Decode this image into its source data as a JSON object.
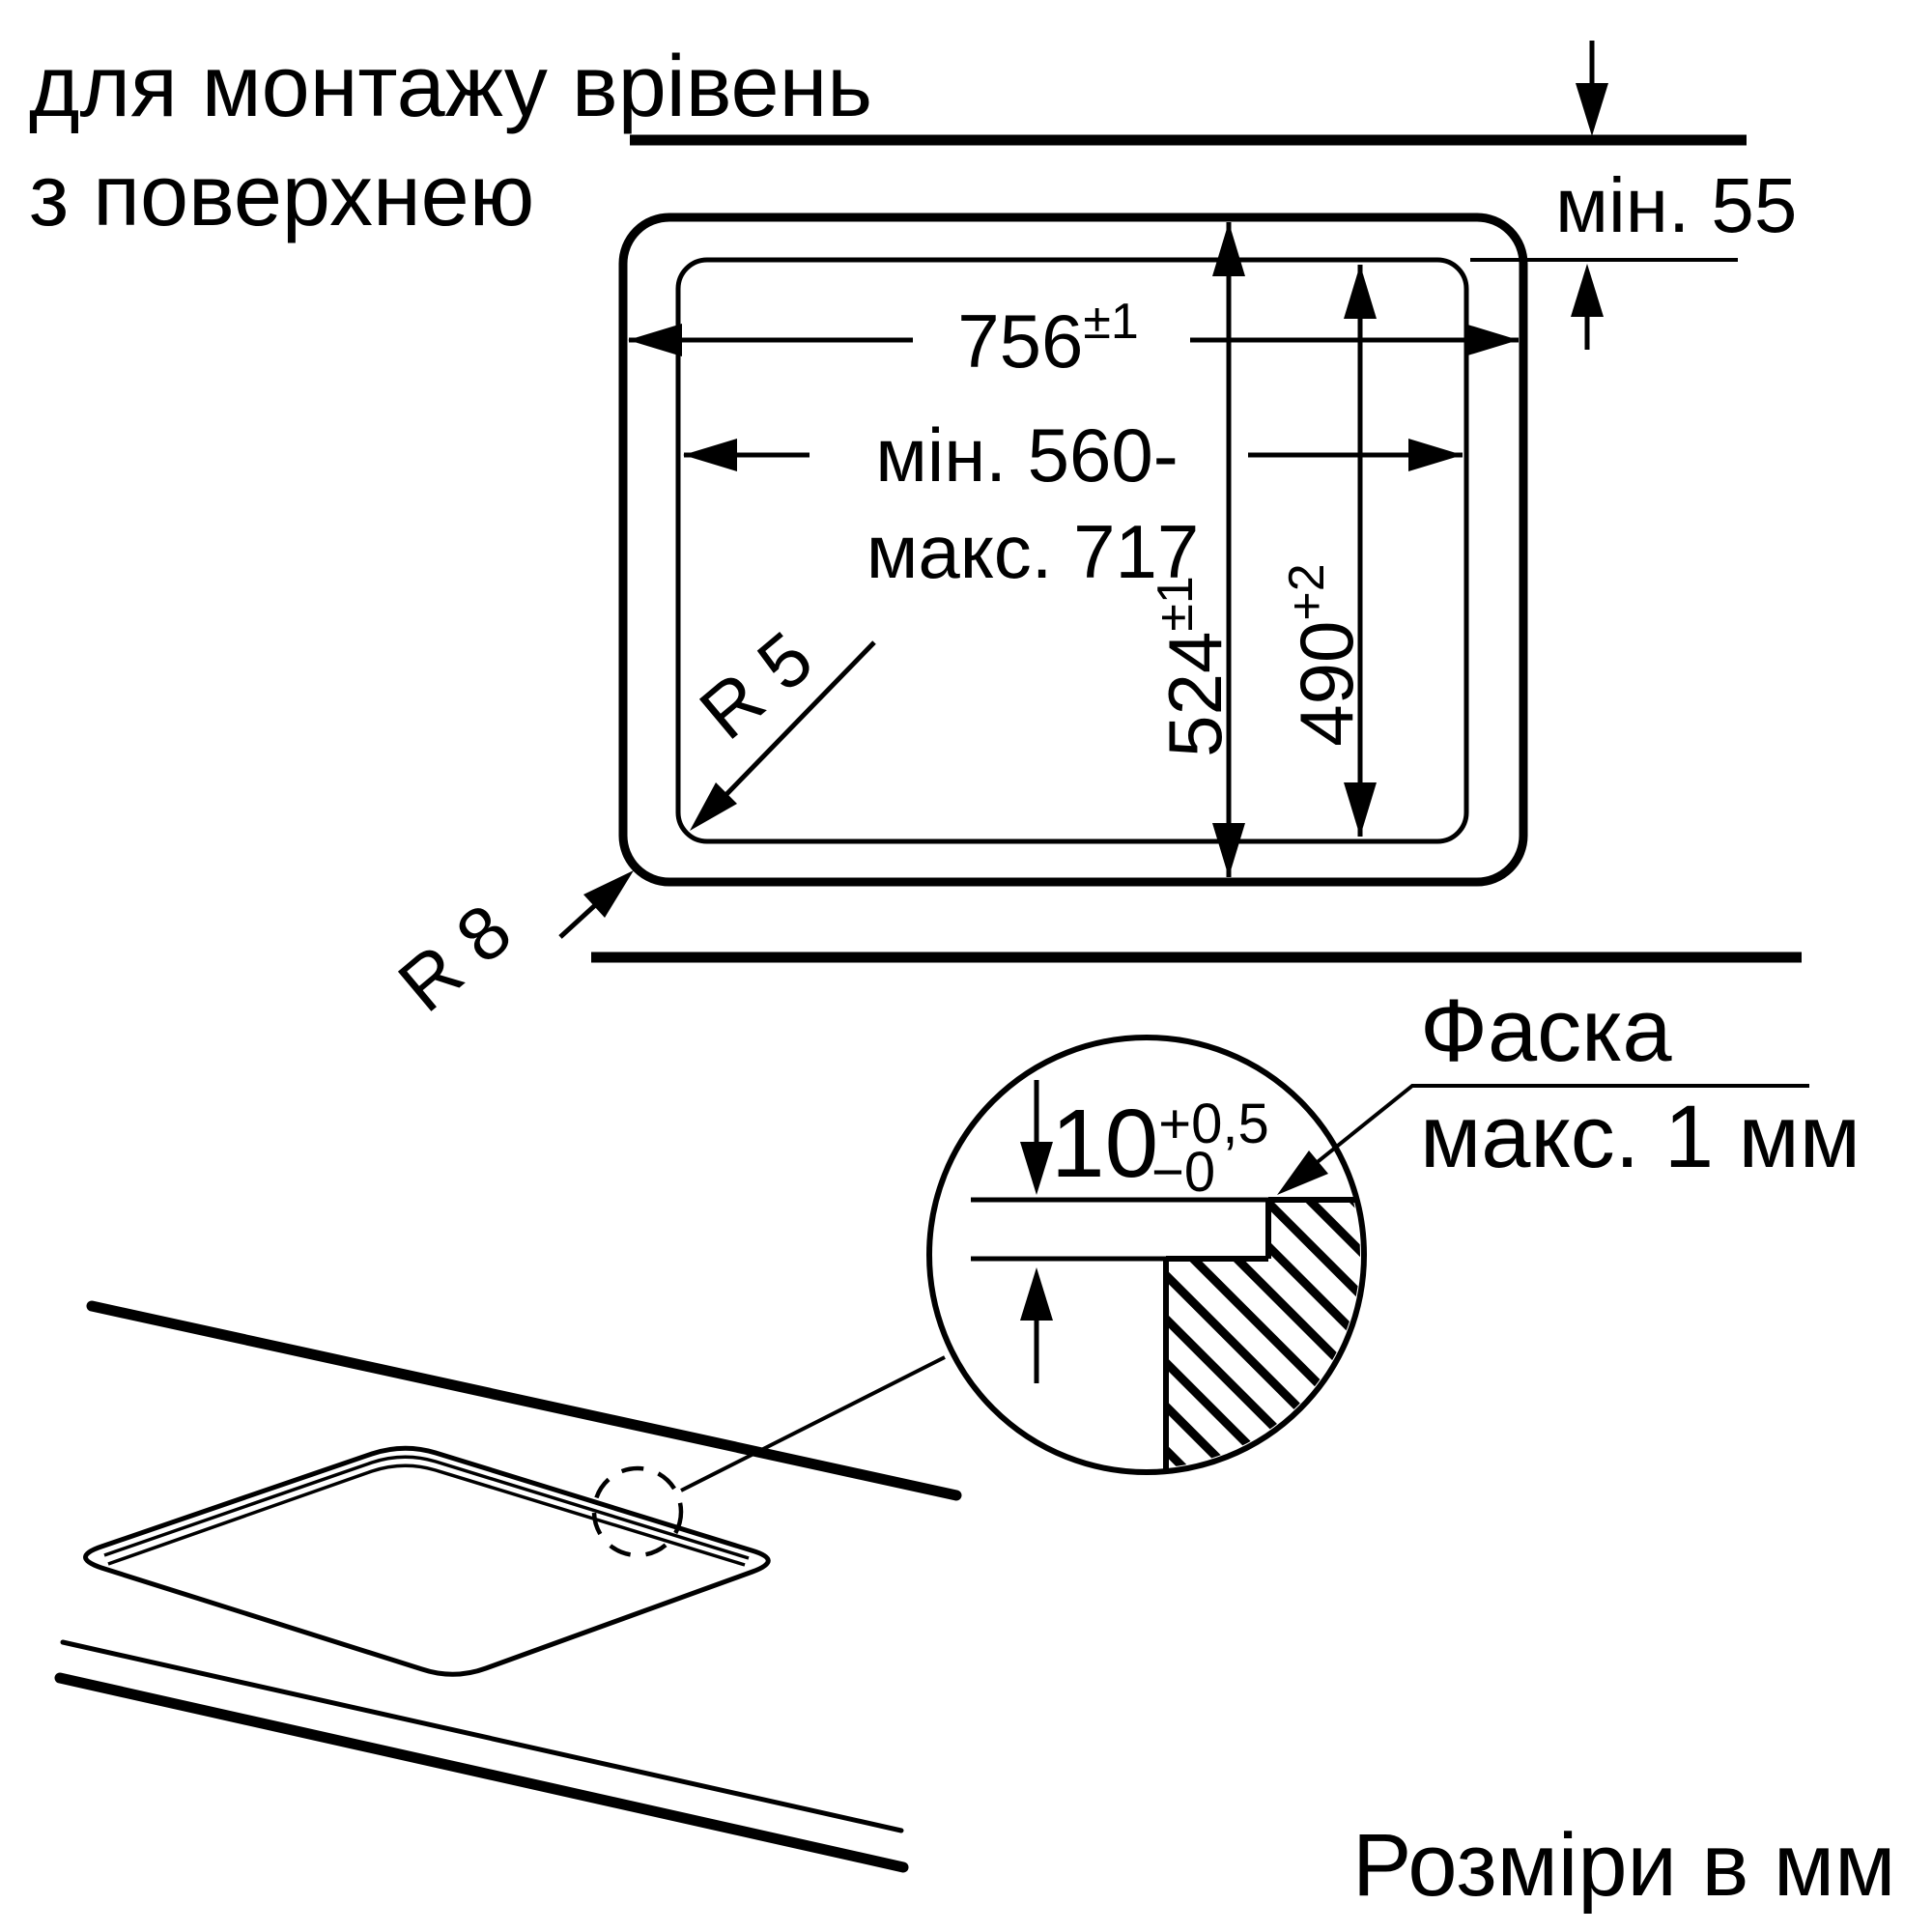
{
  "colors": {
    "ink": "#000000",
    "background": "#ffffff"
  },
  "title": {
    "line1": "для монтажу врівень",
    "line2": "з поверхнею"
  },
  "dimensions": {
    "top_clearance": "мін. 55",
    "outer_width": {
      "value": "756",
      "tolerance": "±1"
    },
    "inner_width_line1": "мін. 560-",
    "inner_width_line2": "макс. 717",
    "outer_depth": {
      "value": "524",
      "tolerance": "±1"
    },
    "inner_depth": {
      "value": "490",
      "tolerance": "+2"
    },
    "inner_corner_radius": "R 5",
    "outer_corner_radius": "R 8",
    "recess_depth": {
      "value": "10",
      "tolerance_upper": "+0,5",
      "tolerance_lower": "−0"
    },
    "chamfer_line1": "Фаска",
    "chamfer_line2": "макс. 1 мм"
  },
  "footer": {
    "units_note": "Розміри в мм"
  }
}
